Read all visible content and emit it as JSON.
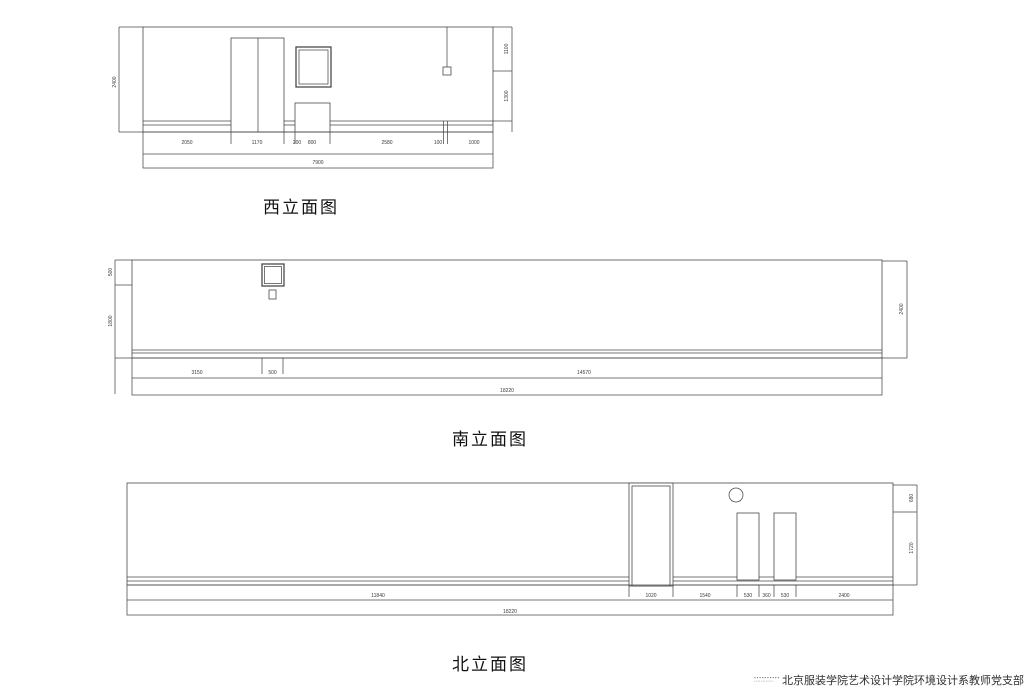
{
  "colors": {
    "line": "#4a4a4a",
    "dim_text": "#3a3a3a",
    "title": "#111111",
    "footer": "#2f2f2f",
    "watermark": "#a9605c"
  },
  "west_elevation": {
    "title": "西立面图",
    "dim_left_height": "2400",
    "dim_right_upper": "1100",
    "dim_right_lower": "1300",
    "dims_bottom": [
      "2050",
      "1170",
      "200",
      "800",
      "2580",
      "100",
      "1000"
    ],
    "dim_total": "7900"
  },
  "south_elevation": {
    "title": "南立面图",
    "dim_left_upper": "500",
    "dim_left_lower": "1800",
    "dim_right_height": "2400",
    "dims_bottom": [
      "3150",
      "500",
      "14570"
    ],
    "dim_total": "18220"
  },
  "north_elevation": {
    "title": "北立面图",
    "dim_right_upper": "680",
    "dim_right_lower": "1720",
    "dims_bottom": [
      "11840",
      "1020",
      "1540",
      "530",
      "360",
      "530",
      "2400"
    ],
    "dim_total": "18220"
  },
  "footer": {
    "watermark_line1": "▪▪▪▪▪▪▪▪▪▪",
    "watermark_line2": "▪▪▪▪▪▪▪▪▪▪▪▪",
    "credit": "北京服装学院艺术设计学院环境设计系教师党支部"
  }
}
